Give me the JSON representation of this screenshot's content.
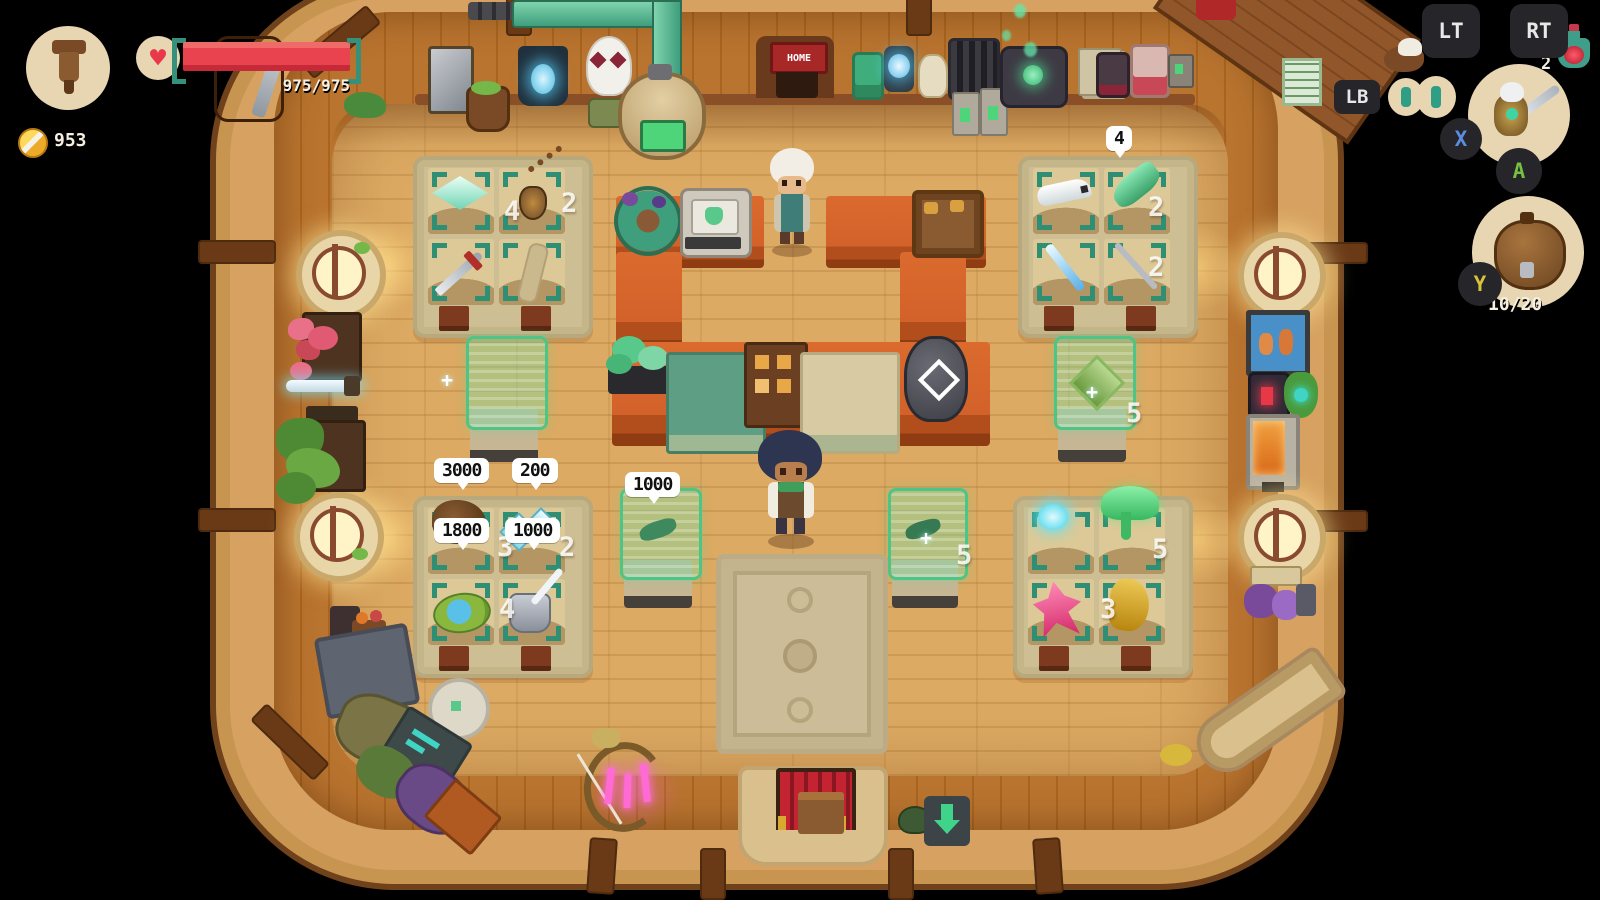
{
  "hud": {
    "health_text": "975/975",
    "gold_amount": "953",
    "heart_icon": "♥",
    "potion_count": "2",
    "inventory_count": "10/20",
    "buttons": {
      "lt": "LT",
      "rt": "RT",
      "lb": "LB",
      "x": "X",
      "a": "A",
      "y": "Y"
    }
  },
  "shop": {
    "home_sign": "HOME",
    "bubbles": {
      "root_cluster": "3000",
      "blue_crystals": "200",
      "pond_mirror": "1800",
      "armor": "1000",
      "case_fish": "1000",
      "green_fish": "4"
    },
    "quantities": {
      "crystal_plate": "4",
      "amulet": "2",
      "green_fish": "2",
      "grey_spear": "2",
      "root_cluster": "3",
      "blue_crystals": "2",
      "pond_mirror": "4",
      "green_slime": "5",
      "pink_crystal": "3",
      "case_right": "5",
      "case_center_right": "5"
    },
    "plus": "+"
  },
  "colors": {
    "health_red": "#e8434e",
    "teal_accent": "#35907c",
    "gold": "#eda928",
    "button_x_blue": "#5b8de0",
    "button_a_green": "#76c043",
    "button_y_yellow": "#d8c23c",
    "case_green": "#4ec487",
    "counter_orange": "#d2622a"
  }
}
